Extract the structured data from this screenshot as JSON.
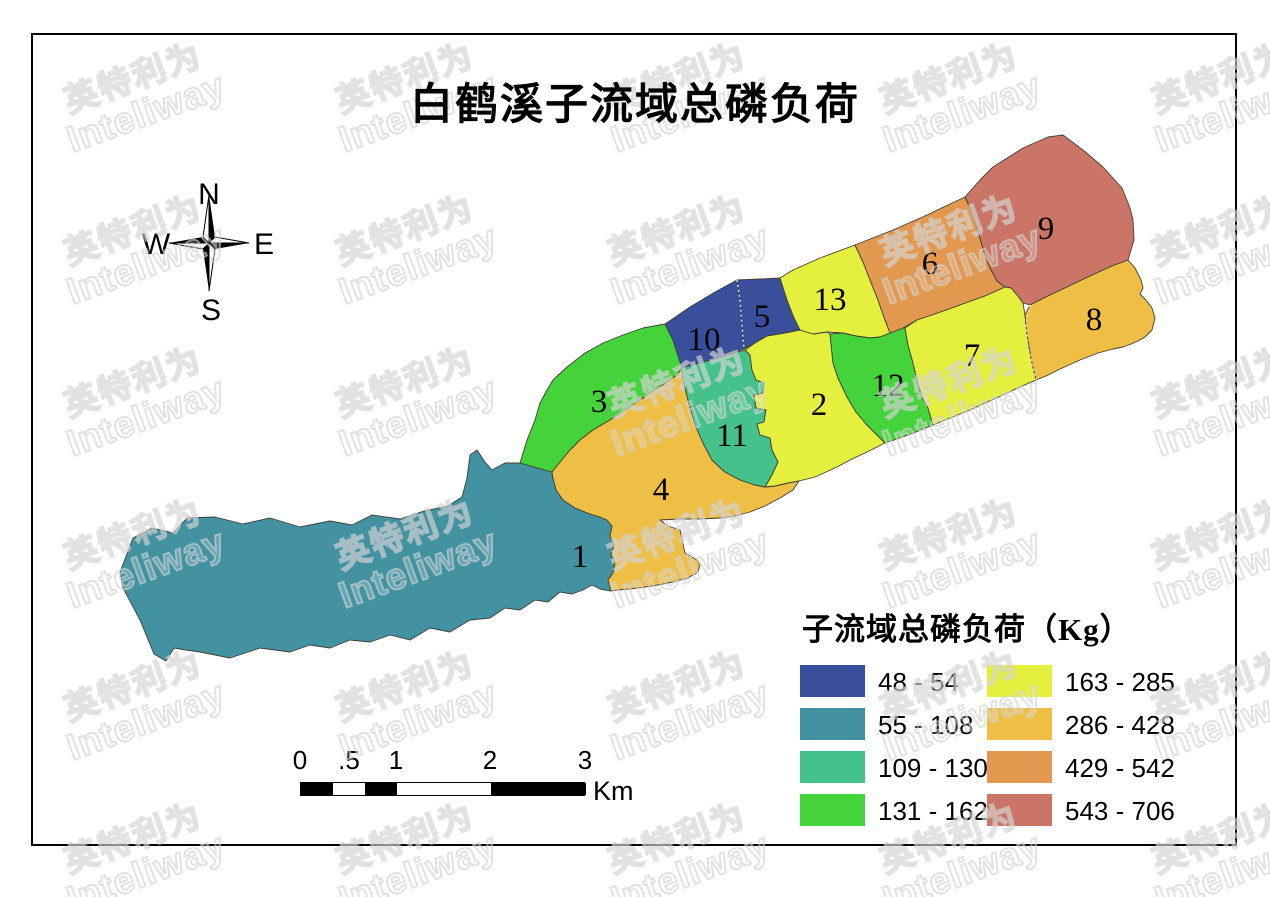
{
  "title": "白鹤溪子流域总磷负荷",
  "compass": {
    "north": "N",
    "south": "S",
    "east": "E",
    "west": "W"
  },
  "watermark": {
    "line1": "英特利为",
    "line2": "Inteliway"
  },
  "legend": {
    "title": "子流域总磷负荷（Kg）",
    "items": [
      {
        "label": "48 - 54",
        "color": "#3A4F9B"
      },
      {
        "label": "55 - 108",
        "color": "#4292A1"
      },
      {
        "label": "109 - 130",
        "color": "#45C28B"
      },
      {
        "label": "131 - 162",
        "color": "#45D33B"
      },
      {
        "label": "163 - 285",
        "color": "#E5EF3D"
      },
      {
        "label": "286 - 428",
        "color": "#EEBE45"
      },
      {
        "label": "429 - 542",
        "color": "#E2984E"
      },
      {
        "label": "543 - 706",
        "color": "#CA7565"
      }
    ]
  },
  "scalebar": {
    "labels": [
      "0",
      ".5",
      "1",
      "2",
      "3"
    ],
    "unit": "Km"
  },
  "map": {
    "border_color": "#3f3f35",
    "divider_color": "#e3e3e3",
    "dividers": [
      "737,280 740,300 742,325 744,349",
      "1030,305 1026,325 1028,348 1033,365 1036,380"
    ],
    "regions": [
      {
        "num": "1",
        "load_range": "55 - 108",
        "color": "#4292A1",
        "label": [
          580,
          556
        ],
        "points": "120,572 133,538 152,528 173,533 187,518 215,517 243,524 270,518 300,527 330,521 352,525 372,515 400,519 424,511 448,506 462,497 467,478 470,455 477,450 485,462 492,470 505,463 520,463 552,472 553,478 556,490 563,500 575,508 590,514 600,517 607,520 612,526 610,536 614,545 611,555 615,563 613,573 608,580 611,591 600,589 592,585 583,590 572,594 560,592 548,602 535,600 520,610 505,608 490,618 470,620 450,632 430,628 410,640 390,635 370,642 350,640 330,648 310,645 290,652 260,648 230,658 200,652 186,650 174,648 166,661 154,654 140,620 123,588"
      },
      {
        "num": "3",
        "load_range": "131 - 162",
        "color": "#45D33B",
        "label": [
          599,
          401
        ],
        "points": "520,463 527,440 535,420 540,403 547,390 553,380 567,367 585,353 603,343 623,335 643,328 665,324 673,340 682,368 677,375 667,382 653,391 640,400 625,410 610,420 593,430 580,440 570,450 552,472"
      },
      {
        "num": "4",
        "load_range": "286 - 428",
        "color": "#EEBE45",
        "label": [
          661,
          489
        ],
        "points": "552,472 570,450 580,440 593,430 610,420 625,410 640,400 653,391 667,382 677,375 682,368 683,380 688,400 695,425 703,443 712,460 725,472 740,480 755,485 765,487 775,486 788,483 799,481 793,490 780,498 765,506 750,512 735,516 720,518 700,519 680,519 660,520 668,526 680,530 683,544 685,553 697,560 700,565 698,572 688,578 673,582 658,585 645,587 630,589 618,590 611,591 608,580 613,573 615,563 611,555 614,545 610,536 612,526 607,520 600,517 590,514 575,508 563,500 556,490 553,478"
      },
      {
        "num": "10",
        "load_range": "48 - 54",
        "color": "#3A4F9B",
        "label": [
          704,
          339
        ],
        "points": "665,324 690,307 715,292 737,280 740,300 742,325 744,349 722,357 700,363 682,368 673,340"
      },
      {
        "num": "5",
        "load_range": "48 - 54",
        "color": "#3A4F9B",
        "label": [
          762,
          316
        ],
        "points": "737,280 760,279 780,278 787,300 794,318 800,330 785,333 767,336 755,343 744,349 742,325 740,300"
      },
      {
        "num": "11",
        "load_range": "109 - 130",
        "color": "#45C28B",
        "label": [
          732,
          435
        ],
        "points": "682,368 700,363 722,357 745,350 750,355 752,370 756,380 764,383 763,393 754,395 756,408 766,410 764,422 757,424 760,435 770,438 772,450 778,462 772,475 765,487 755,485 740,480 725,472 712,460 703,443 695,425 688,400 683,380"
      },
      {
        "num": "2",
        "load_range": "163 - 285",
        "color": "#E5EF3D",
        "label": [
          819,
          404
        ],
        "points": "745,350 755,343 767,336 785,333 800,330 813,334 827,332 830,334 833,363 838,378 847,397 856,412 866,424 876,434 885,443 867,452 850,460 837,467 815,477 799,481 788,483 775,486 765,487 772,475 778,462 772,450 770,438 760,435 757,424 764,422 766,410 756,408 754,395 763,393 764,383 756,380 752,370 750,355"
      },
      {
        "num": "13",
        "load_range": "163 - 285",
        "color": "#E5EF3D",
        "label": [
          830,
          299
        ],
        "points": "780,278 787,300 794,318 800,330 813,334 827,332 843,333 856,336 870,338 880,337 890,333 885,320 878,300 870,280 863,262 855,245 820,258 793,270"
      },
      {
        "num": "12",
        "load_range": "131 - 162",
        "color": "#45D33B",
        "label": [
          888,
          385
        ],
        "points": "830,334 843,333 856,336 870,338 880,337 890,333 903,328 905,328 908,345 913,363 917,380 922,397 928,408 933,425 916,432 900,438 885,443 876,434 866,424 856,412 847,397 838,378 833,363"
      },
      {
        "num": "6",
        "load_range": "429 - 542",
        "color": "#E2984E",
        "label": [
          930,
          263
        ],
        "points": "855,245 893,230 927,215 950,204 965,197 971,210 977,228 984,252 990,268 997,281 1005,287 985,296 960,305 935,314 917,320 903,328 890,333 885,320 878,300 870,280 863,262"
      },
      {
        "num": "9",
        "load_range": "543 - 706",
        "color": "#CA7565",
        "label": [
          1046,
          228
        ],
        "points": "965,197 980,180 993,167 1023,148 1048,137 1063,135 1083,150 1103,167 1122,188 1130,208 1133,220 1134,240 1128,260 1112,266 1090,276 1067,287 1048,296 1030,305 1023,303 1017,295 1011,288 1005,287 997,281 990,268 984,252 977,228 971,210"
      },
      {
        "num": "7",
        "load_range": "163 - 285",
        "color": "#E5EF3D",
        "label": [
          972,
          355
        ],
        "points": "905,328 917,320 935,314 960,305 985,296 1005,287 1011,288 1017,295 1023,303 1025,315 1027,335 1031,358 1036,380 1020,387 1003,395 985,403 970,410 950,418 933,425 928,408 922,397 917,380 913,363 908,345"
      },
      {
        "num": "8",
        "load_range": "286 - 428",
        "color": "#EEBE45",
        "label": [
          1094,
          319
        ],
        "points": "1030,305 1048,296 1067,287 1090,276 1112,266 1128,260 1135,268 1141,280 1143,288 1140,294 1146,300 1152,308 1155,318 1152,330 1145,337 1138,341 1131,344 1123,347 1113,349 1098,353 1080,360 1060,369 1046,376 1036,380 1031,358 1027,335 1025,315"
      }
    ]
  }
}
